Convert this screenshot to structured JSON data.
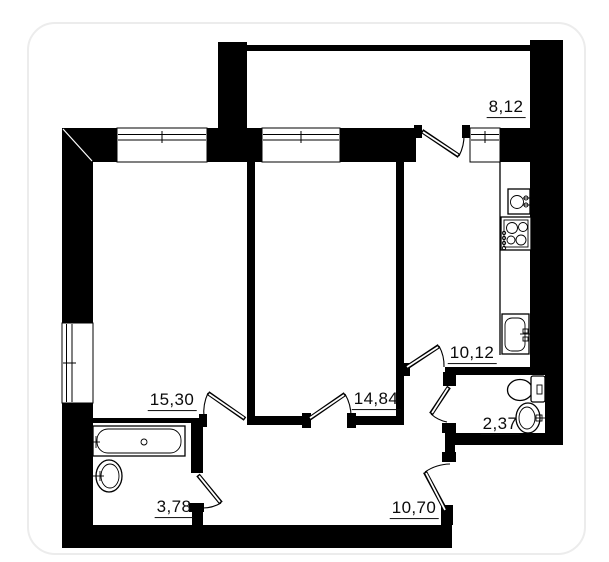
{
  "plan": {
    "title": "apartment floor plan",
    "rooms": [
      {
        "id": "loggia",
        "area": "8,12"
      },
      {
        "id": "kitchen",
        "area": "10,12"
      },
      {
        "id": "room-1",
        "area": "15,30"
      },
      {
        "id": "room-2",
        "area": "14,84"
      },
      {
        "id": "wc",
        "area": "2,37"
      },
      {
        "id": "bathroom",
        "area": "3,78"
      },
      {
        "id": "hallway",
        "area": "10,70"
      }
    ],
    "fixtures": [
      "bathtub",
      "bathroom-basin",
      "toilet",
      "wc-basin",
      "kitchen-round-sink",
      "stove",
      "kitchen-sink"
    ],
    "colors": {
      "wall": "#000000",
      "floor": "#ffffff",
      "card_border": "#ececec",
      "label": "#0b0b0b"
    }
  }
}
